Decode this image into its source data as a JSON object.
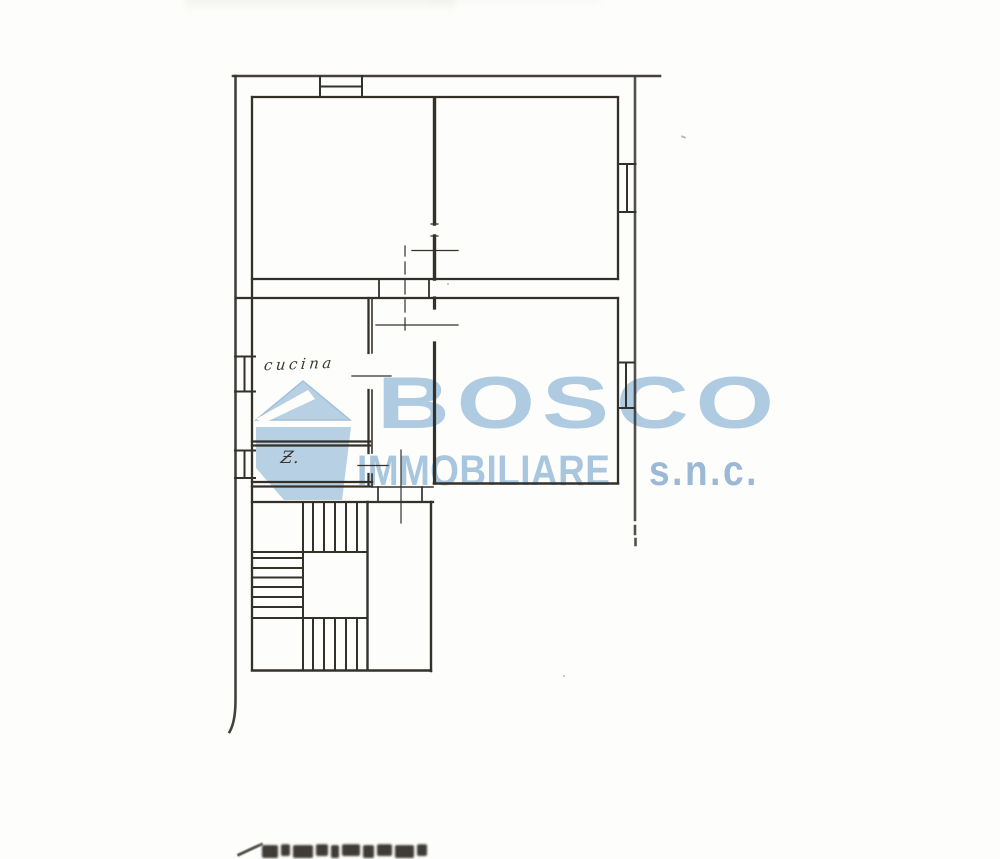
{
  "page": {
    "background_color": "#fdfdfb",
    "kind_label": "scanned floor plan"
  },
  "watermark": {
    "brand": "BOSCO",
    "line2_word": "IMMOBILIARE",
    "line2_suffix": "s.n.c.",
    "brand_color": "#afcbe2",
    "word_color": "#a9c6df",
    "suffix_color": "#9bb9d6",
    "logo_color": "#b7d0e4",
    "logo_edge_color": "#a2c1da",
    "logo_name": "mountain-z-logo"
  },
  "floorplan": {
    "line_color": "#34312b",
    "rooms": [
      {
        "label": "cucina"
      },
      {
        "label": "Ƶ."
      }
    ],
    "elements": {
      "staircase": "u-shaped-staircase-icon",
      "window": "double-line-window-icon",
      "door": "door-opening-with-swing-line"
    }
  }
}
